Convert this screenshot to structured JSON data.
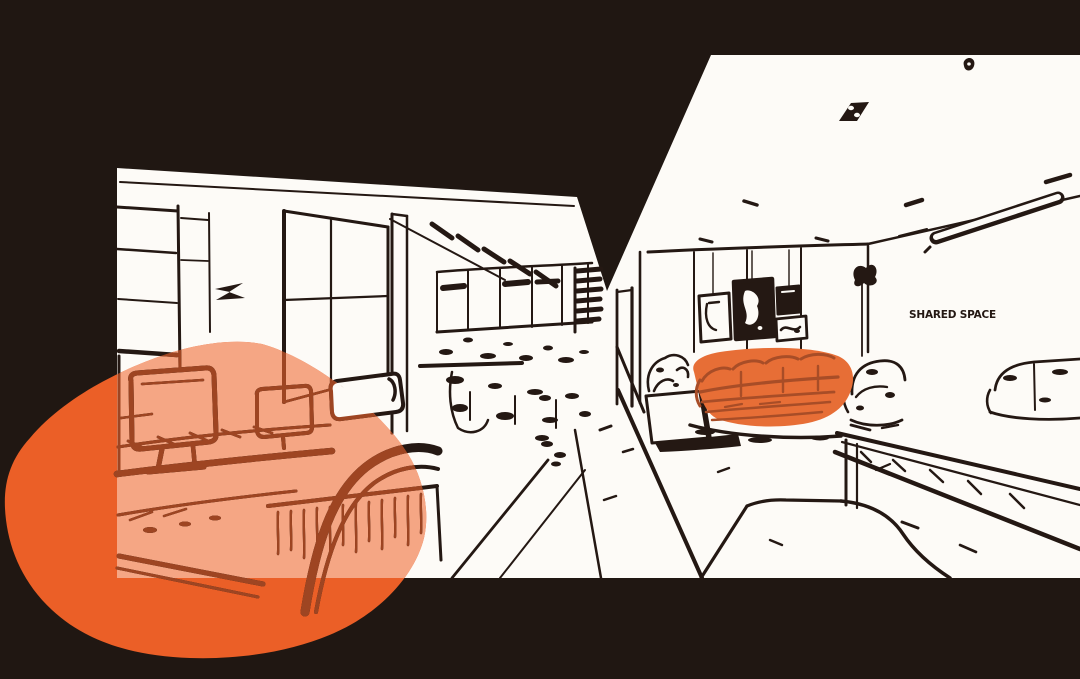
{
  "scene": {
    "wall_sign": {
      "text": "SHARED SPACE"
    },
    "style": "black ink line-art office interior with orange accent blobs on dark background",
    "rooms": [
      {
        "name": "open-workspace",
        "side": "left"
      },
      {
        "name": "lounge-area",
        "side": "right"
      }
    ],
    "highlights": [
      {
        "name": "workspace-desk-highlight",
        "shape": "large organic blob over foreground desks"
      },
      {
        "name": "lounge-sofa-highlight",
        "shape": "organic blob over the three-seat sofa"
      }
    ],
    "objects": [
      "wall-cabinet",
      "glass-partition",
      "ceiling-hatch",
      "window-band",
      "desk-monitor",
      "desk-monitor-small",
      "office-chair",
      "chair-headrest",
      "wood-grain-cabinet",
      "corridor-shelf",
      "corridor-door",
      "rug-edge",
      "gallery-frames",
      "pendant-light",
      "ceiling-spotlight",
      "main-sofa",
      "side-table",
      "armchair",
      "floor-plant",
      "far-sofa",
      "console-table",
      "walkway-curve"
    ]
  },
  "colors": {
    "ink_black": "#201712",
    "ink": "#241813",
    "paper": "#FDFBF7",
    "accent_orange": "#EB5F27",
    "accent_salmon": "#F5A684",
    "rust": "#9E4522",
    "sofa_orange": "#E76E36",
    "sofa_rust": "#A84D27"
  }
}
